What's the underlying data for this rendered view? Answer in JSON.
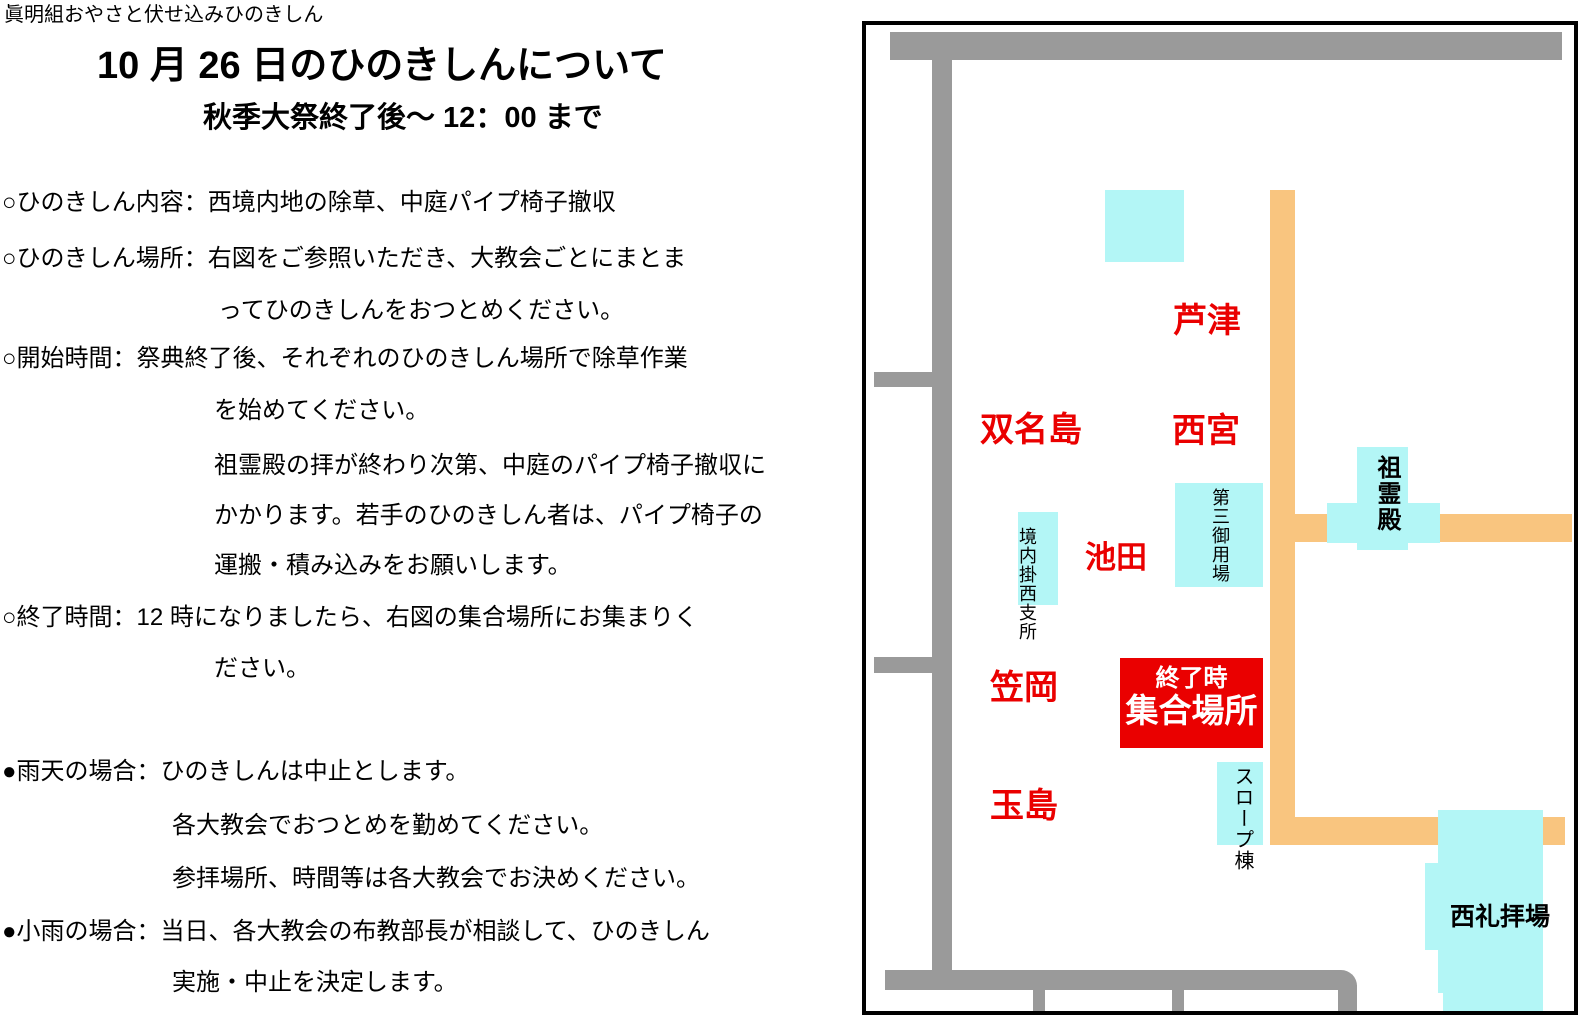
{
  "doc": {
    "header": "眞明組おやさと伏せ込みひのきしん",
    "title": "10 月 26 日のひのきしんについて",
    "subtitle": "秋季大祭終了後〜 12：00 まで",
    "lines": [
      {
        "text": "○ひのきしん内容：西境内地の除草、中庭パイプ椅子撤収"
      },
      {
        "text": "○ひのきしん場所：右図をご参照いただき、大教会ごとにまとま"
      },
      {
        "text": "ってひのきしんをおつとめください。"
      },
      {
        "text": "○開始時間：祭典終了後、それぞれのひのきしん場所で除草作業"
      },
      {
        "text": "を始めてください。"
      },
      {
        "text": "祖霊殿の拝が終わり次第、中庭のパイプ椅子撤収に"
      },
      {
        "text": "かかります。若手のひのきしん者は、パイプ椅子の"
      },
      {
        "text": "運搬・積み込みをお願いします。"
      },
      {
        "text": "○終了時間：12 時になりましたら、右図の集合場所にお集まりく"
      },
      {
        "text": "ださい。"
      },
      {
        "text": "●雨天の場合：ひのきしんは中止とします。"
      },
      {
        "text": "各大教会でおつとめを勤めてください。"
      },
      {
        "text": "参拝場所、時間等は各大教会でお決めください。"
      },
      {
        "text": "●小雨の場合：当日、各大教会の布教部長が相談して、ひのきしん"
      },
      {
        "text": "実施・中止を決定します。"
      }
    ]
  },
  "map": {
    "labels": {
      "ashizu": "芦津",
      "funameshima": "双名島",
      "nishinomiya": "西宮",
      "ikeda": "池田",
      "kasaoka": "笠岡",
      "tamashima": "玉島"
    },
    "buildings": {
      "kenai_branch": "境内掛西支所",
      "daisan_goyoba": "第三御用場",
      "soreiden": "祖霊殿",
      "slope_building": "スロープ棟",
      "nishi_worship_hall": "西礼拝場"
    },
    "meet_box": {
      "line1": "終了時",
      "line2": "集合場所"
    },
    "colors": {
      "road_gray": "#9a9a9a",
      "path_orange": "#f9c57f",
      "building_cyan": "#b3f6f6",
      "accent_red": "#ea0000"
    }
  }
}
